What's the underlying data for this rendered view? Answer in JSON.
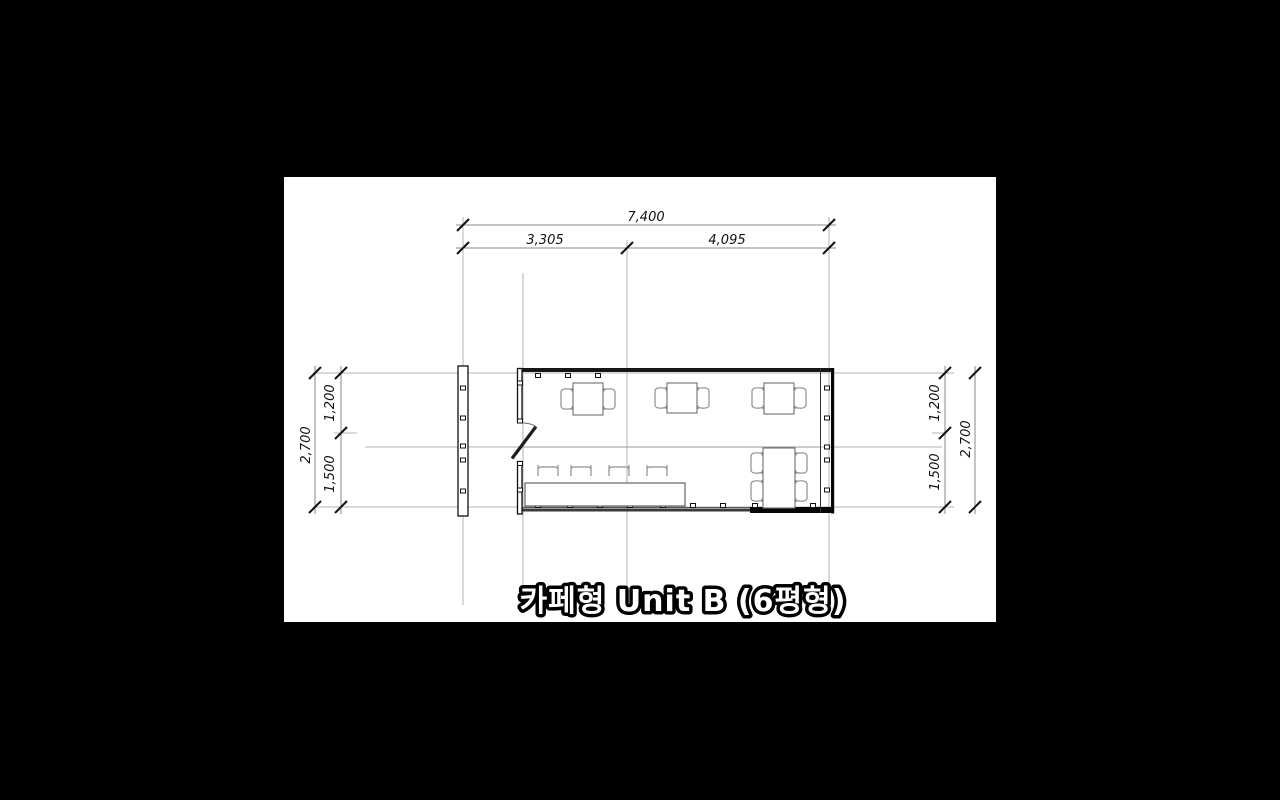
{
  "title": {
    "text": "카페형 Unit B (6평형)"
  },
  "dimensions": {
    "top": {
      "total": "7,400",
      "left_span": "3,305",
      "right_span": "4,095"
    },
    "left": {
      "overall": "2,700",
      "upper": "1,200",
      "lower": "1,500"
    },
    "right": {
      "upper": "1,200",
      "overall": "2,700",
      "lower": "1,500"
    }
  },
  "colors": {
    "page_bg": "#000000",
    "canvas_bg": "#ffffff",
    "wall": "#111111",
    "grid_line": "#b3b3b3",
    "dim_line": "#8a8a8a",
    "furniture": "#777777",
    "title_fill": "#ffffff",
    "title_outline": "#000000"
  }
}
